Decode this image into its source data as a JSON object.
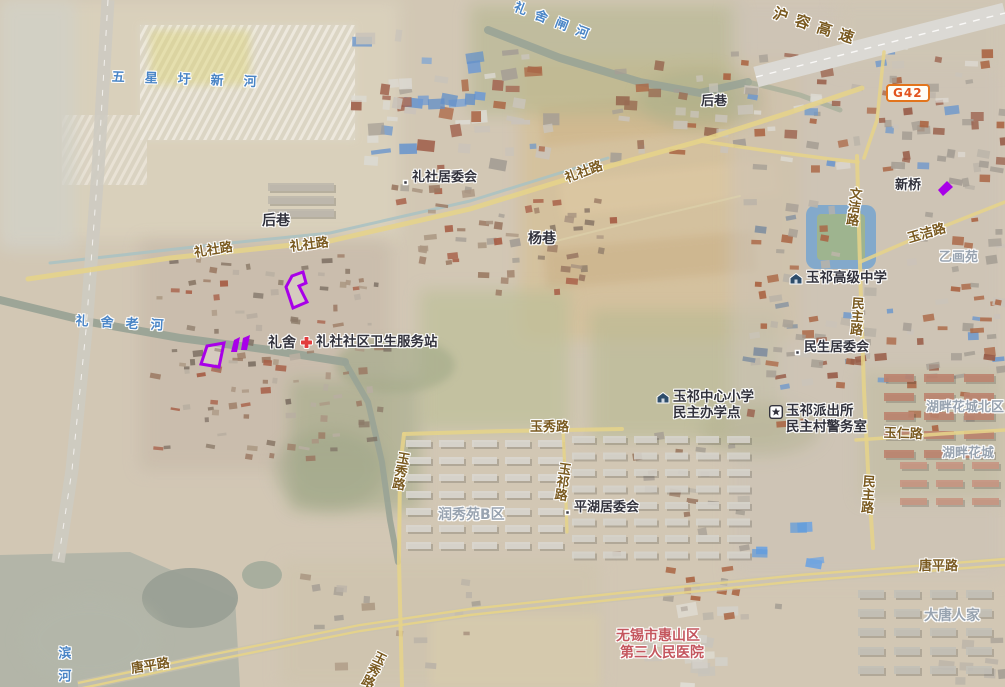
{
  "map": {
    "shield": {
      "code": "G42",
      "x": 886,
      "y": 84,
      "border": "#e2741c",
      "text_color": "#e2531c"
    },
    "colors": {
      "water": "#4a85c6",
      "road": "#7a5a20",
      "poi": "#32323c",
      "area": "#98a3b0",
      "hospital": "#c4565e",
      "annotation": "#a800e8"
    },
    "labels": [
      {
        "id": "wuxingwei-xinhe-river-label",
        "type": "water",
        "text": "五星圩新河",
        "x": 112,
        "y": 70,
        "fs": 13,
        "ls": 20,
        "rot": 2
      },
      {
        "id": "lishe-laohe-river-label",
        "type": "water",
        "text": "礼舍老河",
        "x": 76,
        "y": 314,
        "fs": 13,
        "ls": 12,
        "rot": 3
      },
      {
        "id": "lishe-zhahe-river-label",
        "type": "water",
        "text": "礼舍闸河",
        "x": 517,
        "y": 0,
        "fs": 13,
        "ls": 9,
        "rot": 21
      },
      {
        "id": "binhe-river-label",
        "type": "water",
        "text": "滨河",
        "x": 55,
        "y": 646,
        "fs": 13,
        "ls": 10,
        "vert": true
      },
      {
        "id": "hurong-expressway-label",
        "type": "road",
        "text": "沪容高速",
        "x": 776,
        "y": 5,
        "fs": 15,
        "ls": 8,
        "rot": 18
      },
      {
        "id": "lishe-road-label-west",
        "type": "road",
        "text": "礼社路",
        "x": 193,
        "y": 246,
        "fs": 13,
        "rot": -9
      },
      {
        "id": "lishe-road-label-mid",
        "type": "road",
        "text": "礼社路",
        "x": 289,
        "y": 240,
        "fs": 13,
        "rot": -7
      },
      {
        "id": "lishe-road-label-east",
        "type": "road",
        "text": "礼社路",
        "x": 563,
        "y": 172,
        "fs": 13,
        "rot": -20
      },
      {
        "id": "yujie-road-label",
        "type": "road",
        "text": "玉洁路",
        "x": 906,
        "y": 232,
        "fs": 13,
        "rot": -16
      },
      {
        "id": "wenjie-road-label",
        "type": "road",
        "text": "文洁路",
        "x": 847,
        "y": 186,
        "fs": 13,
        "vert": true,
        "rot": 7
      },
      {
        "id": "minzhu-road-label-north",
        "type": "road",
        "text": "民主路",
        "x": 849,
        "y": 296,
        "fs": 13,
        "vert": true,
        "rot": 4
      },
      {
        "id": "minzhu-road-label-south",
        "type": "road",
        "text": "民主路",
        "x": 860,
        "y": 474,
        "fs": 13,
        "vert": true,
        "rot": 4
      },
      {
        "id": "yuxiu-road-label-east",
        "type": "road",
        "text": "玉秀路",
        "x": 530,
        "y": 420,
        "fs": 13
      },
      {
        "id": "yuxiu-road-label-vertical",
        "type": "road",
        "text": "玉秀路",
        "x": 395,
        "y": 450,
        "fs": 13,
        "vert": true,
        "rot": 10
      },
      {
        "id": "yuqi-road-label",
        "type": "road",
        "text": "玉祁路",
        "x": 556,
        "y": 461,
        "fs": 13,
        "vert": true,
        "rot": 8
      },
      {
        "id": "yuren-road-label",
        "type": "road",
        "text": "玉仁路",
        "x": 884,
        "y": 426,
        "fs": 13,
        "rot": 2
      },
      {
        "id": "tangping-road-label-east",
        "type": "road",
        "text": "唐平路",
        "x": 919,
        "y": 559,
        "fs": 13
      },
      {
        "id": "tangping-road-label-west",
        "type": "road",
        "text": "唐平路",
        "x": 130,
        "y": 662,
        "fs": 13,
        "rot": -9
      },
      {
        "id": "yuxiu-road-label-south",
        "type": "road",
        "text": "玉秀路",
        "x": 374,
        "y": 648,
        "fs": 13,
        "vert": true,
        "rot": 26
      },
      {
        "id": "lishe-residents-committee-poi",
        "type": "poi",
        "text": "礼社居委会",
        "x": 402,
        "y": 170,
        "fs": 13,
        "icon": "dot"
      },
      {
        "id": "houxiang-village-poi-west",
        "type": "poi",
        "text": "后巷",
        "x": 262,
        "y": 213,
        "fs": 14
      },
      {
        "id": "yangxiang-village-poi",
        "type": "poi",
        "text": "杨巷",
        "x": 528,
        "y": 231,
        "fs": 14
      },
      {
        "id": "houxiang-village-poi-north",
        "type": "poi",
        "text": "后巷",
        "x": 701,
        "y": 94,
        "fs": 13
      },
      {
        "id": "lishe-village-poi",
        "type": "poi",
        "text": "礼舍",
        "x": 268,
        "y": 335,
        "fs": 14
      },
      {
        "id": "lishe-community-health-station-poi",
        "type": "poi",
        "text": "礼社社区卫生服务站",
        "x": 300,
        "y": 335,
        "fs": 13.5,
        "icon": "cross"
      },
      {
        "id": "xinqiao-poi",
        "type": "poi",
        "text": "新桥",
        "x": 895,
        "y": 178,
        "fs": 13
      },
      {
        "id": "yuqi-senior-high-school-poi",
        "type": "poi",
        "text": "玉祁高级中学",
        "x": 789,
        "y": 271,
        "fs": 13.5,
        "icon": "school"
      },
      {
        "id": "minsheng-residents-committee-poi",
        "type": "poi",
        "text": "民生居委会",
        "x": 794,
        "y": 340,
        "fs": 13,
        "icon": "dot"
      },
      {
        "id": "yuqi-central-primary-school-poi",
        "type": "poi",
        "lines": [
          "玉祁中心小学",
          "民主办学点"
        ],
        "x": 656,
        "y": 390,
        "fs": 13.5,
        "icon": "school"
      },
      {
        "id": "yuqi-police-station-poi",
        "type": "poi",
        "lines": [
          "玉祁派出所",
          "民主村警务室"
        ],
        "x": 769,
        "y": 404,
        "fs": 13.5,
        "icon": "police"
      },
      {
        "id": "pinghu-residents-committee-poi",
        "type": "poi",
        "text": "平湖居委会",
        "x": 564,
        "y": 500,
        "fs": 13,
        "icon": "dot"
      },
      {
        "id": "yihuayuan-estate-label",
        "type": "area",
        "text": "乙画苑",
        "x": 939,
        "y": 250,
        "fs": 13
      },
      {
        "id": "hupan-huacheng-north-estate-label",
        "type": "area",
        "text": "湖畔花城北区",
        "x": 926,
        "y": 400,
        "fs": 13
      },
      {
        "id": "hupan-huacheng-estate-label",
        "type": "area",
        "text": "湖畔花城",
        "x": 942,
        "y": 446,
        "fs": 13
      },
      {
        "id": "runxiuyuan-b-estate-label",
        "type": "area",
        "text": "润秀苑B区",
        "x": 438,
        "y": 507,
        "fs": 14
      },
      {
        "id": "datang-renjia-estate-label",
        "type": "area",
        "text": "大唐人家",
        "x": 924,
        "y": 608,
        "fs": 14
      },
      {
        "id": "huishan-third-peoples-hospital-label",
        "type": "hospital",
        "lines": [
          "无锡市惠山区",
          "第三人民医院"
        ],
        "x": 616,
        "y": 628,
        "fs": 14
      }
    ],
    "annotations": {
      "color": "#a800e8",
      "shapes": [
        {
          "id": "plot-outline-a",
          "mode": "outline",
          "points": "292,276 303,272 306,283 299,286 307,302 293,308 286,287"
        },
        {
          "id": "plot-outline-b",
          "mode": "outline",
          "points": "207,346 224,343 219,367 201,364"
        },
        {
          "id": "plot-fill-1",
          "mode": "filled",
          "points": "234,340 240,337 237,352 231,352"
        },
        {
          "id": "plot-fill-2",
          "mode": "filled",
          "points": "243,338 250,335 247,350 241,350"
        },
        {
          "id": "plot-fill-3",
          "mode": "filled",
          "points": "938,190 947,181 953,187 943,196"
        }
      ]
    }
  }
}
